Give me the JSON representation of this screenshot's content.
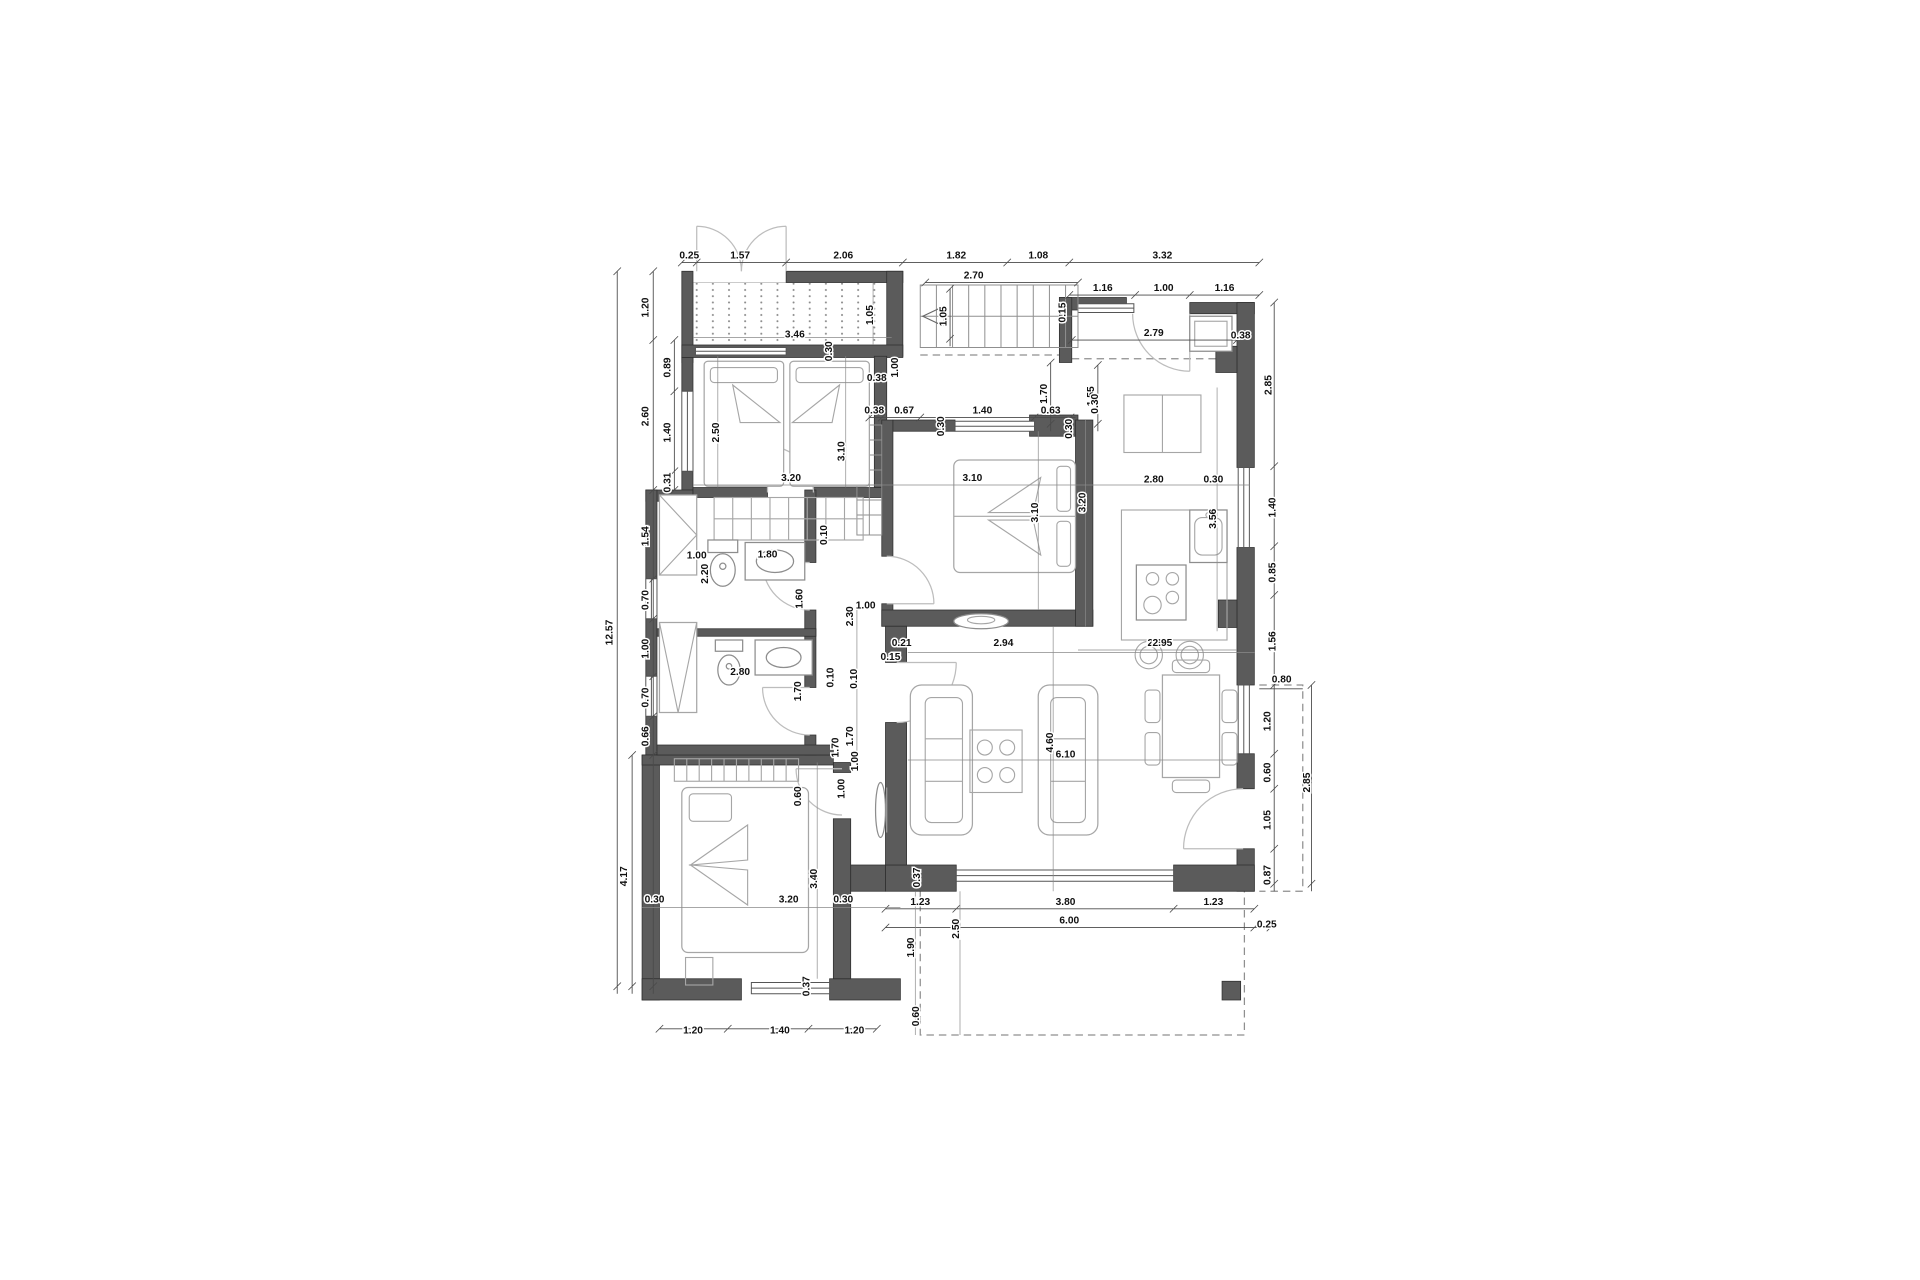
{
  "drawing": {
    "kind": "architectural floor plan",
    "units_note": "dimensions in meters",
    "colors": {
      "wall": "#5b5b5b",
      "line": "#4a4a4a",
      "furniture": "#a6a6a6",
      "background": "#ffffff"
    }
  },
  "dimension_labels": [
    {
      "t": "0.25",
      "x": 555,
      "y": 207,
      "r": 0
    },
    {
      "t": "1.57",
      "x": 596,
      "y": 207,
      "r": 0
    },
    {
      "t": "2.06",
      "x": 679,
      "y": 207,
      "r": 0
    },
    {
      "t": "1.82",
      "x": 770,
      "y": 207,
      "r": 0
    },
    {
      "t": "1.08",
      "x": 836,
      "y": 207,
      "r": 0
    },
    {
      "t": "3.32",
      "x": 936,
      "y": 207,
      "r": 0
    },
    {
      "t": "1.16",
      "x": 888,
      "y": 233,
      "r": 0
    },
    {
      "t": "1.00",
      "x": 937,
      "y": 233,
      "r": 0
    },
    {
      "t": "1.16",
      "x": 986,
      "y": 233,
      "r": 0
    },
    {
      "t": "2.70",
      "x": 784,
      "y": 223,
      "r": 0
    },
    {
      "t": "2.79",
      "x": 929,
      "y": 269,
      "r": 0
    },
    {
      "t": "3.46",
      "x": 640,
      "y": 270,
      "r": 0
    },
    {
      "t": "1.05",
      "x": 703,
      "y": 252,
      "r": 1
    },
    {
      "t": "1.05",
      "x": 762,
      "y": 253,
      "r": 1
    },
    {
      "t": "0.30",
      "x": 670,
      "y": 281,
      "r": 1
    },
    {
      "t": "0.38",
      "x": 706,
      "y": 305,
      "r": 0
    },
    {
      "t": "1.00",
      "x": 723,
      "y": 294,
      "r": 1
    },
    {
      "t": "1.70",
      "x": 843,
      "y": 315,
      "r": 1
    },
    {
      "t": "1.55",
      "x": 881,
      "y": 317,
      "r": 1
    },
    {
      "t": "0.15",
      "x": 858,
      "y": 250,
      "r": 1
    },
    {
      "t": "0.38",
      "x": 999,
      "y": 271,
      "r": 0
    },
    {
      "t": "2.85",
      "x": 1024,
      "y": 308,
      "r": 1
    },
    {
      "t": "0.30",
      "x": 884,
      "y": 323,
      "r": 1
    },
    {
      "t": "12.57",
      "x": 493,
      "y": 506,
      "r": 1
    },
    {
      "t": "1.20",
      "x": 522,
      "y": 246,
      "r": 1
    },
    {
      "t": "2.60",
      "x": 522,
      "y": 333,
      "r": 1
    },
    {
      "t": "1.54",
      "x": 522,
      "y": 429,
      "r": 1
    },
    {
      "t": "0.70",
      "x": 522,
      "y": 480,
      "r": 1
    },
    {
      "t": "1.00",
      "x": 522,
      "y": 519,
      "r": 1
    },
    {
      "t": "0.70",
      "x": 522,
      "y": 558,
      "r": 1
    },
    {
      "t": "0.66",
      "x": 522,
      "y": 589,
      "r": 1
    },
    {
      "t": "4.17",
      "x": 505,
      "y": 701,
      "r": 1
    },
    {
      "t": "0.89",
      "x": 540,
      "y": 294,
      "r": 1
    },
    {
      "t": "1.40",
      "x": 540,
      "y": 346,
      "r": 1
    },
    {
      "t": "0.31",
      "x": 540,
      "y": 386,
      "r": 1
    },
    {
      "t": "2.50",
      "x": 579,
      "y": 346,
      "r": 1
    },
    {
      "t": "3.10",
      "x": 680,
      "y": 361,
      "r": 1
    },
    {
      "t": "3.20",
      "x": 637,
      "y": 385,
      "r": 0
    },
    {
      "t": "0.38",
      "x": 704,
      "y": 331,
      "r": 0
    },
    {
      "t": "0.67",
      "x": 728,
      "y": 331,
      "r": 0
    },
    {
      "t": "1.40",
      "x": 791,
      "y": 331,
      "r": 0
    },
    {
      "t": "0.63",
      "x": 846,
      "y": 331,
      "r": 0
    },
    {
      "t": "0.30",
      "x": 760,
      "y": 341,
      "r": 1
    },
    {
      "t": "0.30",
      "x": 863,
      "y": 343,
      "r": 1
    },
    {
      "t": "3.10",
      "x": 783,
      "y": 385,
      "r": 0
    },
    {
      "t": "3.10",
      "x": 836,
      "y": 410,
      "r": 1
    },
    {
      "t": "3.20",
      "x": 874,
      "y": 402,
      "r": 1
    },
    {
      "t": "2.80",
      "x": 929,
      "y": 386,
      "r": 0
    },
    {
      "t": "0.30",
      "x": 977,
      "y": 386,
      "r": 0
    },
    {
      "t": "3.56",
      "x": 979,
      "y": 415,
      "r": 1
    },
    {
      "t": "2.95",
      "x": 932,
      "y": 517,
      "r": 0
    },
    {
      "t": "1.40",
      "x": 1027,
      "y": 406,
      "r": 1
    },
    {
      "t": "0.85",
      "x": 1027,
      "y": 458,
      "r": 1
    },
    {
      "t": "1.56",
      "x": 1027,
      "y": 513,
      "r": 1
    },
    {
      "t": "1.20",
      "x": 1023,
      "y": 577,
      "r": 1
    },
    {
      "t": "0.60",
      "x": 1023,
      "y": 618,
      "r": 1
    },
    {
      "t": "1.05",
      "x": 1023,
      "y": 656,
      "r": 1
    },
    {
      "t": "0.87",
      "x": 1023,
      "y": 700,
      "r": 1
    },
    {
      "t": "0.80",
      "x": 1032,
      "y": 546,
      "r": 0
    },
    {
      "t": "2.85",
      "x": 1055,
      "y": 626,
      "r": 1
    },
    {
      "t": "1.00",
      "x": 561,
      "y": 447,
      "r": 0
    },
    {
      "t": "2.20",
      "x": 570,
      "y": 459,
      "r": 1
    },
    {
      "t": "1.80",
      "x": 618,
      "y": 446,
      "r": 0
    },
    {
      "t": "1.60",
      "x": 646,
      "y": 479,
      "r": 1
    },
    {
      "t": "0.10",
      "x": 666,
      "y": 428,
      "r": 1
    },
    {
      "t": "2.80",
      "x": 596,
      "y": 540,
      "r": 0
    },
    {
      "t": "1.70",
      "x": 645,
      "y": 553,
      "r": 1
    },
    {
      "t": "0.10",
      "x": 671,
      "y": 542,
      "r": 1
    },
    {
      "t": "1.70",
      "x": 675,
      "y": 598,
      "r": 1
    },
    {
      "t": "0.60",
      "x": 645,
      "y": 637,
      "r": 1
    },
    {
      "t": "1.00",
      "x": 680,
      "y": 631,
      "r": 1
    },
    {
      "t": "2.30",
      "x": 687,
      "y": 493,
      "r": 1
    },
    {
      "t": "1.00",
      "x": 697,
      "y": 487,
      "r": 0
    },
    {
      "t": "0.10",
      "x": 690,
      "y": 543,
      "r": 1
    },
    {
      "t": "1.70",
      "x": 687,
      "y": 589,
      "r": 1
    },
    {
      "t": "1.00",
      "x": 691,
      "y": 609,
      "r": 1
    },
    {
      "t": "0.21",
      "x": 726,
      "y": 517,
      "r": 0
    },
    {
      "t": "2.94",
      "x": 808,
      "y": 517,
      "r": 0
    },
    {
      "t": "2.95",
      "x": 936,
      "y": 517,
      "r": 0
    },
    {
      "t": "0.15",
      "x": 717,
      "y": 528,
      "r": 0
    },
    {
      "t": "6.10",
      "x": 858,
      "y": 606,
      "r": 0
    },
    {
      "t": "4.60",
      "x": 848,
      "y": 594,
      "r": 1
    },
    {
      "t": "0.37",
      "x": 741,
      "y": 702,
      "r": 1
    },
    {
      "t": "1.23",
      "x": 741,
      "y": 724,
      "r": 0
    },
    {
      "t": "3.80",
      "x": 858,
      "y": 724,
      "r": 0
    },
    {
      "t": "1.23",
      "x": 977,
      "y": 724,
      "r": 0
    },
    {
      "t": "6.00",
      "x": 861,
      "y": 739,
      "r": 0
    },
    {
      "t": "0.25",
      "x": 1020,
      "y": 742,
      "r": 0
    },
    {
      "t": "3.40",
      "x": 658,
      "y": 703,
      "r": 1
    },
    {
      "t": "3.20",
      "x": 635,
      "y": 722,
      "r": 0
    },
    {
      "t": "0.30",
      "x": 527,
      "y": 722,
      "r": 0
    },
    {
      "t": "0.30",
      "x": 679,
      "y": 722,
      "r": 0
    },
    {
      "t": "0.37",
      "x": 652,
      "y": 789,
      "r": 1
    },
    {
      "t": "1.20",
      "x": 558,
      "y": 827,
      "r": 0
    },
    {
      "t": "1.40",
      "x": 628,
      "y": 827,
      "r": 0
    },
    {
      "t": "1.20",
      "x": 688,
      "y": 827,
      "r": 0
    },
    {
      "t": "1.90",
      "x": 736,
      "y": 758,
      "r": 1
    },
    {
      "t": "2.50",
      "x": 772,
      "y": 743,
      "r": 1
    },
    {
      "t": "0.60",
      "x": 740,
      "y": 813,
      "r": 1
    }
  ]
}
